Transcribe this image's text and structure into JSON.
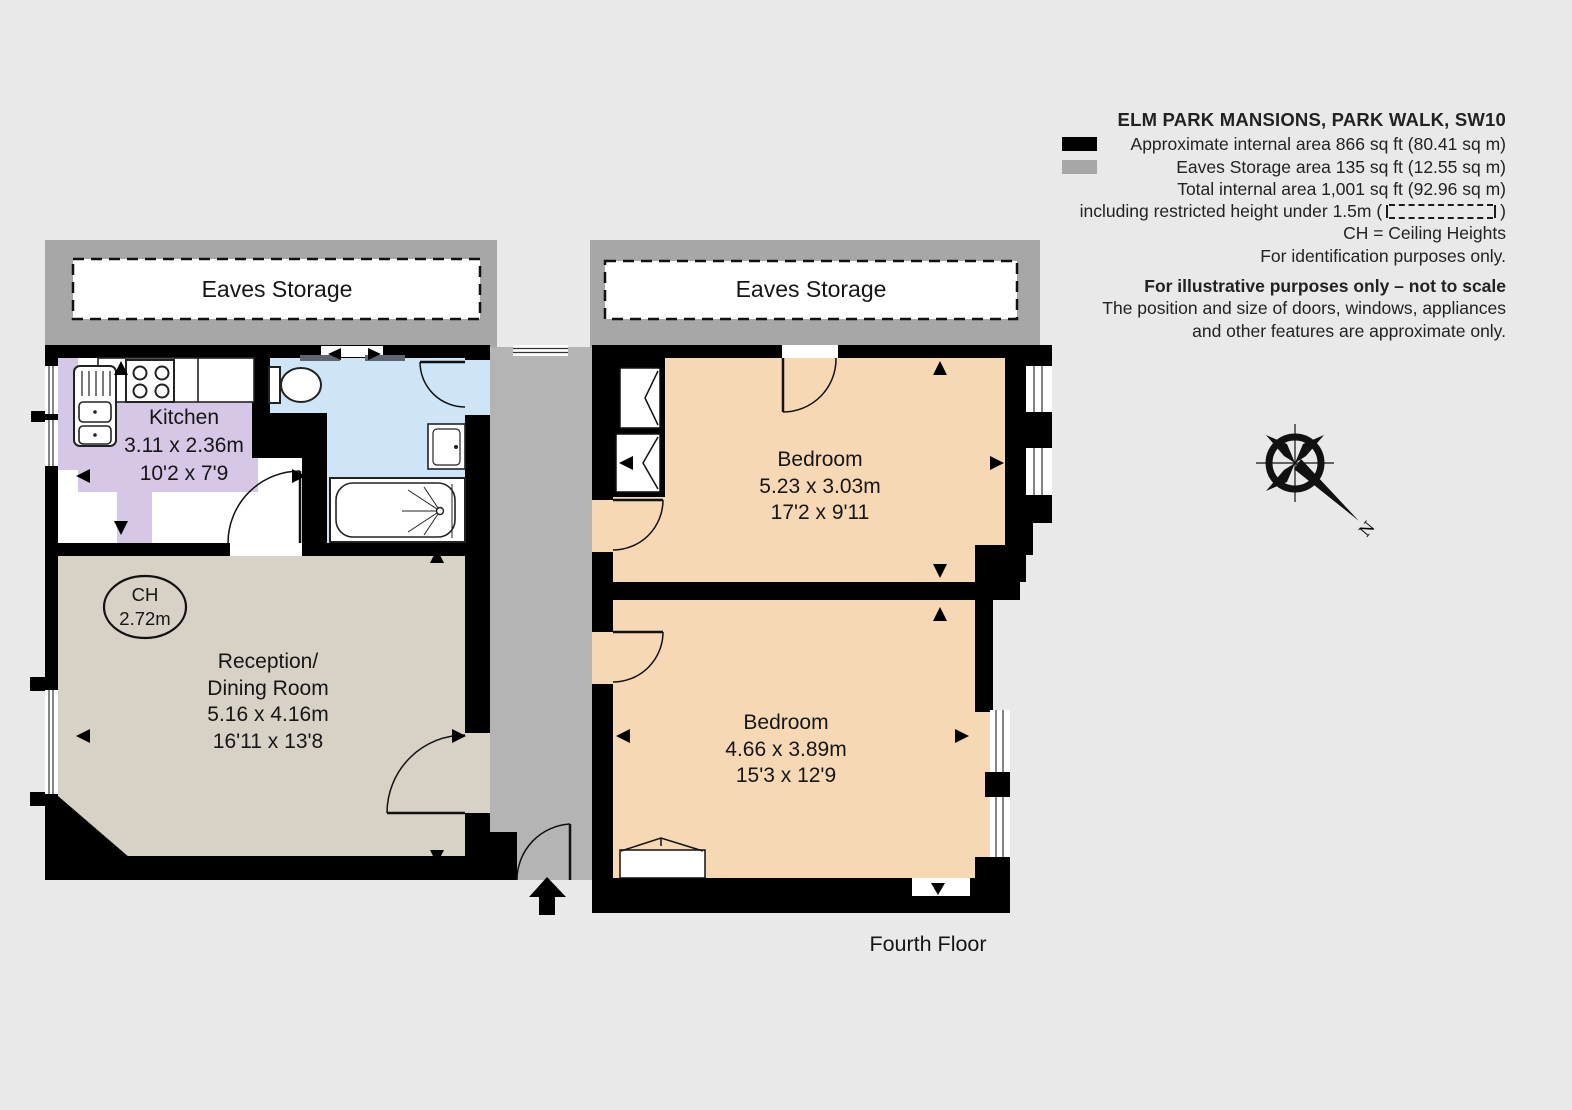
{
  "legend": {
    "title": "ELM PARK MANSIONS, PARK WALK, SW10",
    "area_line1": "Approximate internal area 866 sq ft (80.41 sq m)",
    "area_line2": "Eaves Storage area 135 sq ft (12.55 sq m)",
    "area_line3": "Total internal area 1,001 sq ft (92.96 sq m)",
    "restricted_prefix": "including restricted height under 1.5m (",
    "restricted_suffix": ")",
    "ch_line": "CH =  Ceiling Heights",
    "identification_line": "For identification purposes only.",
    "disclaimer_bold": "For illustrative purposes only – not to scale",
    "disclaimer_line1": "The position and size of doors, windows, appliances",
    "disclaimer_line2": "and other features are approximate only."
  },
  "floorplan": {
    "floor_label": "Fourth Floor",
    "compass_label": "N",
    "eaves_left_label": "Eaves Storage",
    "eaves_right_label": "Eaves Storage",
    "ceiling_height": {
      "abbr": "CH",
      "value": "2.72m"
    },
    "kitchen": {
      "name": "Kitchen",
      "metric": "3.11 x 2.36m",
      "imperial": "10'2 x 7'9"
    },
    "reception": {
      "name_line1": "Reception/",
      "name_line2": "Dining Room",
      "metric": "5.16 x 4.16m",
      "imperial": "16'11 x 13'8"
    },
    "bedroom_top": {
      "name": "Bedroom",
      "metric": "5.23 x 3.03m",
      "imperial": "17'2 x 9'11"
    },
    "bedroom_bottom": {
      "name": "Bedroom",
      "metric": "4.66 x 3.89m",
      "imperial": "15'3 x 12'9"
    }
  },
  "colors": {
    "background": "#e9e9e9",
    "wall": "#000000",
    "eaves_band": "#a7a7a7",
    "corridor": "#b4b4b4",
    "kitchen": "#d7c7e6",
    "bathroom": "#cde5f7",
    "reception": "#d8d1c6",
    "bedroom": "#f6d8b5",
    "swatch_black": "#000000",
    "swatch_gray": "#a7a7a7",
    "window_sill": "#5d6571"
  }
}
